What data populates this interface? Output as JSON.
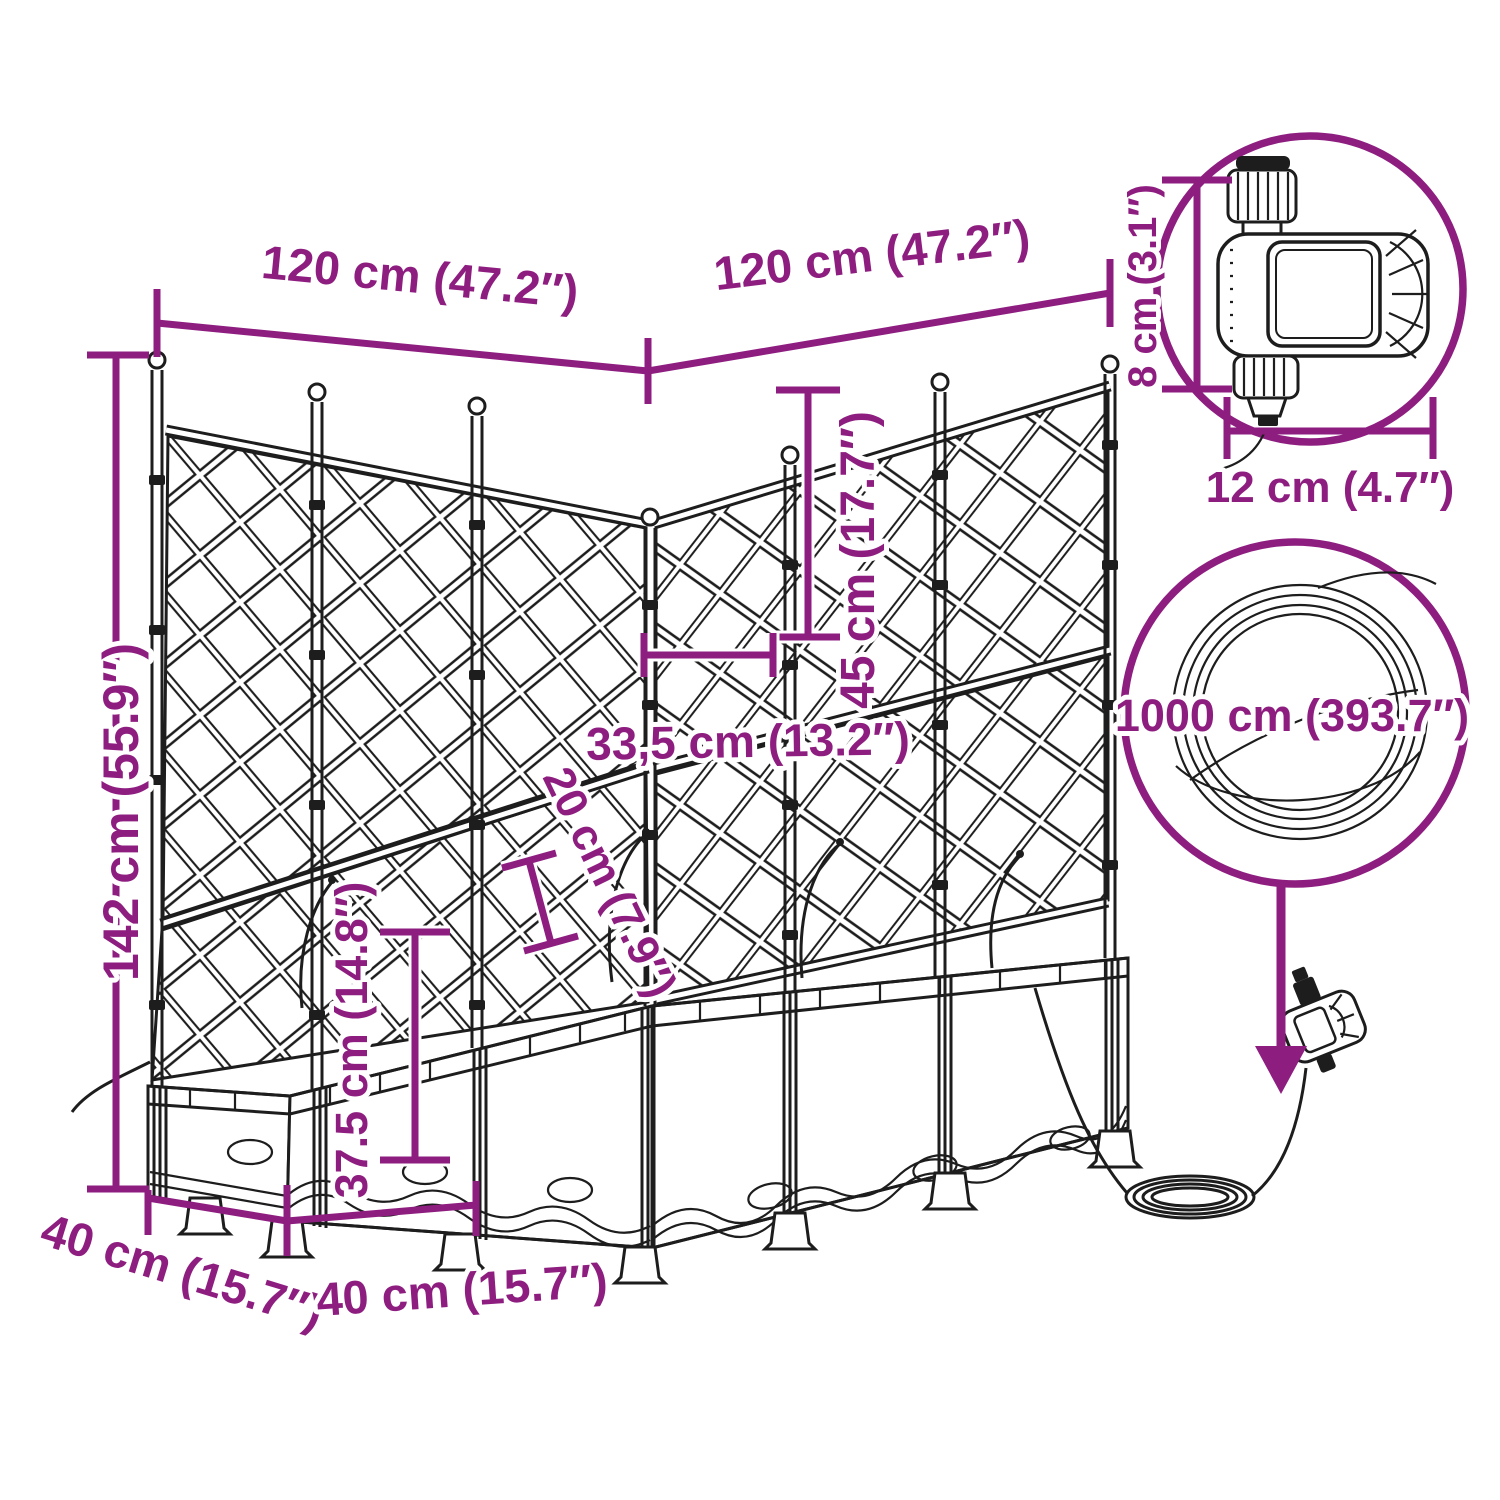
{
  "diagram": {
    "colors": {
      "annotation": "#8e1d80",
      "line_art": "#1d1d1d",
      "background": "#ffffff"
    },
    "labels": {
      "width_left": "120 cm (47.2″)",
      "width_right": "120 cm (47.2″)",
      "total_height": "142 cm (55.9″)",
      "trellis_section_height": "45 cm (17.7″)",
      "lattice_panel_width": "33,5 cm (13.2″)",
      "rim_depth": "20 cm (7.9″)",
      "box_height": "37.5 cm (14.8″)",
      "side_depth": "40 cm (15.7″)",
      "front_module_width": "40 cm (15.7″)",
      "timer_height": "8 cm (3.1″)",
      "timer_width": "12 cm (4.7″)",
      "hose_length": "1000 cm (393.7″)"
    }
  }
}
